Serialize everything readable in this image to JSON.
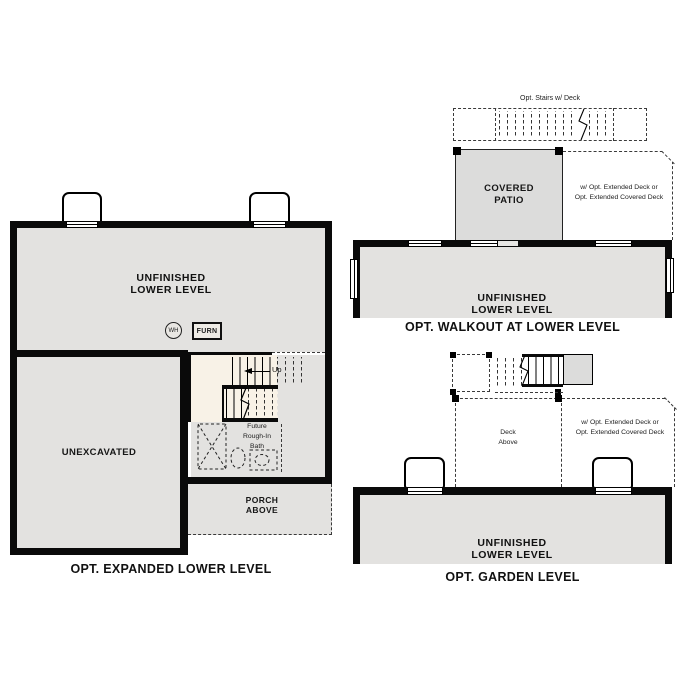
{
  "sheet": {
    "type": "floor-plan-options",
    "background": "#ffffff"
  },
  "colors": {
    "wall": "#0a0a0a",
    "room_fill": "#e3e2e0",
    "stair_fill": "#f8f2e7",
    "patio_fill": "#dcdcdb",
    "dash_line": "#3a3a3a"
  },
  "plans": {
    "expanded": {
      "title": "OPT. EXPANDED LOWER LEVEL",
      "room_label_line1": "UNFINISHED",
      "room_label_line2": "LOWER LEVEL",
      "unexcavated_label": "UNEXCAVATED",
      "wh_label": "WH",
      "furn_label": "FURN",
      "up_label": "Up",
      "bath_label_line1": "Future",
      "bath_label_line2": "Rough-In",
      "bath_label_line3": "Bath",
      "porch_label_line1": "PORCH",
      "porch_label_line2": "ABOVE"
    },
    "walkout": {
      "title": "OPT. WALKOUT AT LOWER LEVEL",
      "stairs_label": "Opt. Stairs w/ Deck",
      "patio_label_line1": "COVERED",
      "patio_label_line2": "PATIO",
      "deck_note_line1": "w/ Opt. Extended Deck or",
      "deck_note_line2": "Opt. Extended Covered Deck",
      "room_label_line1": "UNFINISHED",
      "room_label_line2": "LOWER LEVEL"
    },
    "garden": {
      "title": "OPT. GARDEN LEVEL",
      "deck_label_line1": "Deck",
      "deck_label_line2": "Above",
      "deck_note_line1": "w/ Opt. Extended Deck or",
      "deck_note_line2": "Opt. Extended Covered Deck",
      "room_label_line1": "UNFINISHED",
      "room_label_line2": "LOWER LEVEL"
    }
  }
}
